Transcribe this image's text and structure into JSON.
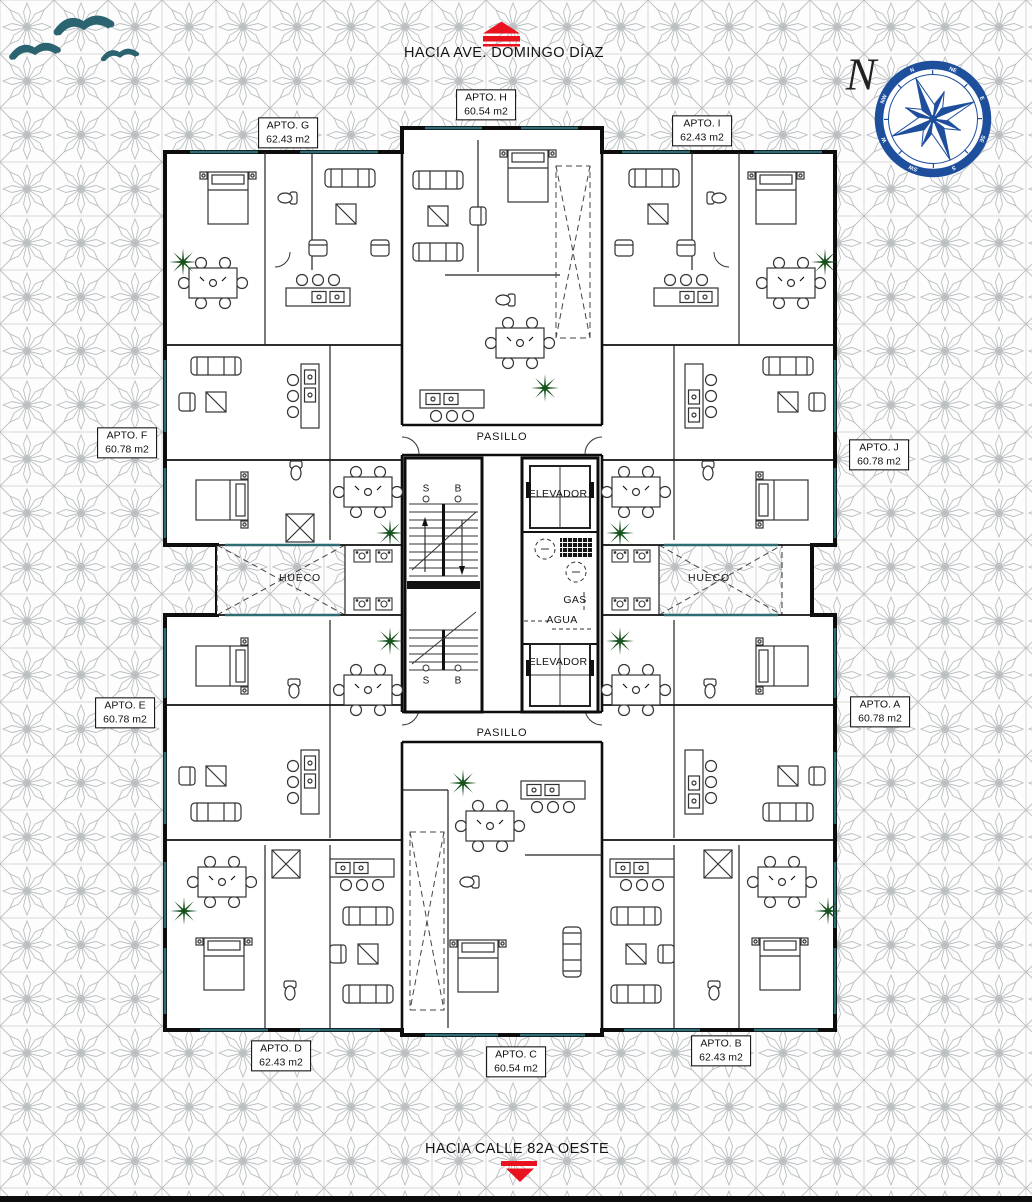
{
  "streets": {
    "top": "HACIA AVE. DOMINGO DÍAZ",
    "bottom": "HACIA CALLE 82A OESTE"
  },
  "compass": {
    "north": "N",
    "ring_labels": [
      "N",
      "NE",
      "E",
      "SE",
      "S",
      "SW",
      "W",
      "NW"
    ]
  },
  "apartments": [
    {
      "name": "APTO. G",
      "area": "62.43 m2"
    },
    {
      "name": "APTO. H",
      "area": "60.54 m2"
    },
    {
      "name": "APTO. I",
      "area": "62.43 m2"
    },
    {
      "name": "APTO. F",
      "area": "60.78 m2"
    },
    {
      "name": "APTO. J",
      "area": "60.78 m2"
    },
    {
      "name": "APTO. E",
      "area": "60.78 m2"
    },
    {
      "name": "APTO. A",
      "area": "60.78 m2"
    },
    {
      "name": "APTO. D",
      "area": "62.43 m2"
    },
    {
      "name": "APTO. C",
      "area": "60.54 m2"
    },
    {
      "name": "APTO. B",
      "area": "62.43 m2"
    }
  ],
  "plan_labels": {
    "pasillo": "PASILLO",
    "hueco": "HUECO",
    "elevador": "ELEVADOR",
    "gas": "GAS",
    "agua": "AGUA",
    "stair_s": "S",
    "stair_b": "B"
  },
  "colors": {
    "wall": "#0d0d0d",
    "arrow_red": "#e8131f",
    "compass_blue": "#1e4f9d",
    "bird_teal": "#2c6370",
    "plant_green": "#17521c",
    "window_teal": "#2e6b73",
    "pattern_gray": "#bcc1c3"
  }
}
